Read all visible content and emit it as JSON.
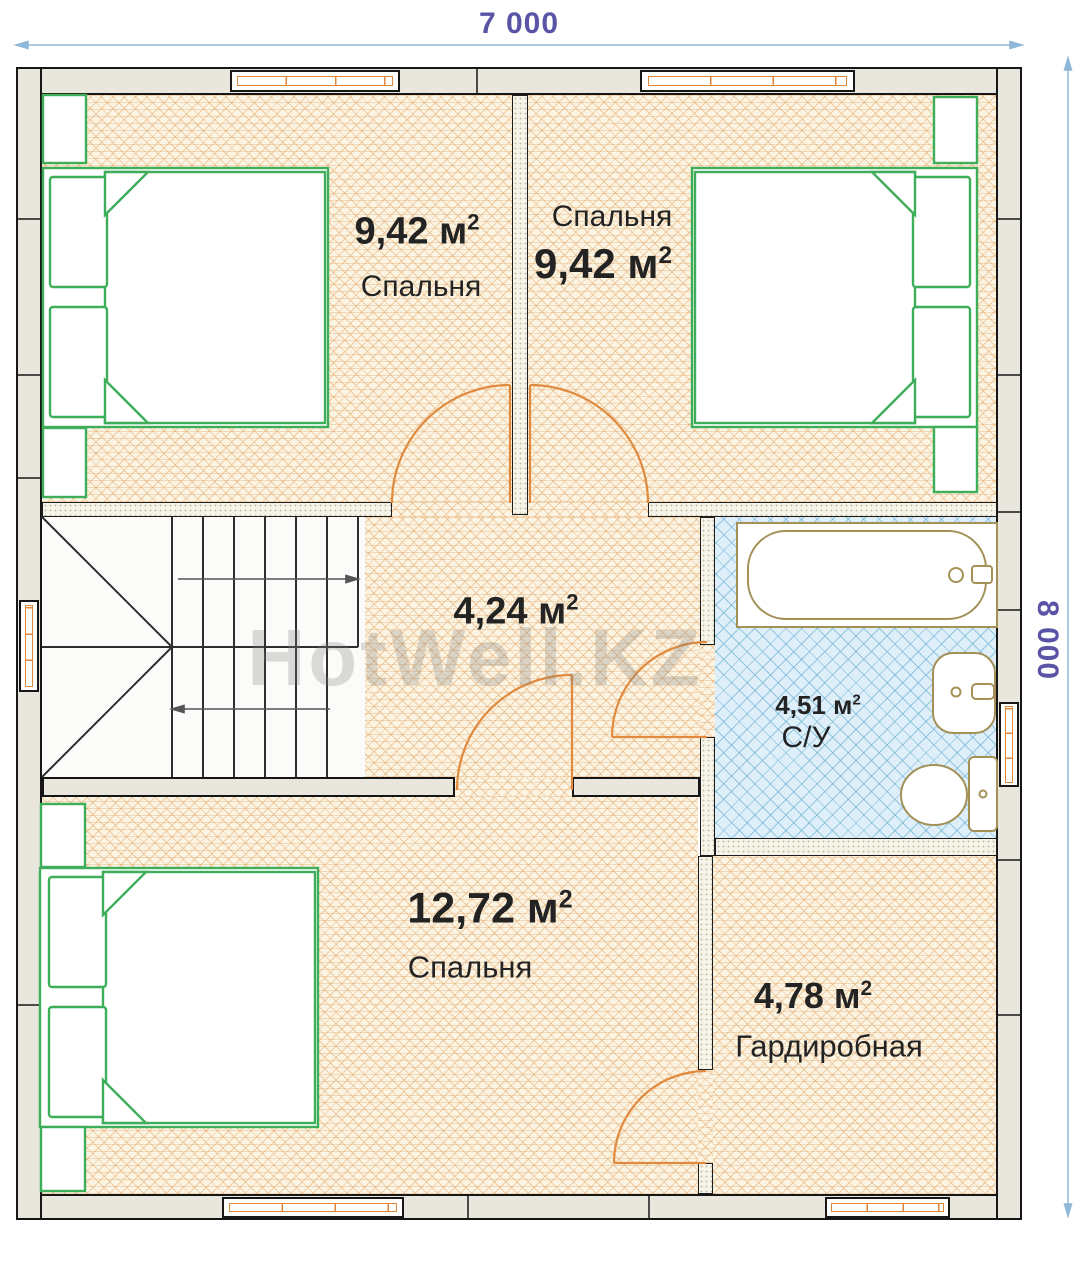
{
  "plan": {
    "dimensions": {
      "width_label": "7 000",
      "height_label": "8 000"
    },
    "watermark": "HotWell.KZ",
    "rooms": {
      "bedroom_top_left": {
        "area": "9,42 м",
        "sup": "2",
        "name": "Спальня"
      },
      "bedroom_top_right": {
        "area": "9,42 м",
        "sup": "2",
        "name": "Спальня"
      },
      "hall": {
        "area": "4,24 м",
        "sup": "2"
      },
      "bathroom": {
        "area": "4,51 м",
        "sup": "2",
        "name": "С/У"
      },
      "bedroom_bottom": {
        "area": "12,72 м",
        "sup": "2",
        "name": "Спальня"
      },
      "wardrobe": {
        "area": "4,78 м",
        "sup": "2",
        "name": "Гардиробная"
      }
    },
    "colors": {
      "wall_fill": "#e9e6dd",
      "wood_line": "#dd9752",
      "tile_line": "#60aacd",
      "furniture_green": "#3fae5a",
      "fixture_tan": "#a39158",
      "door_orange": "#df8a3e",
      "dimension_line": "#8fb8d8",
      "dimension_text": "#5b54a6"
    }
  }
}
